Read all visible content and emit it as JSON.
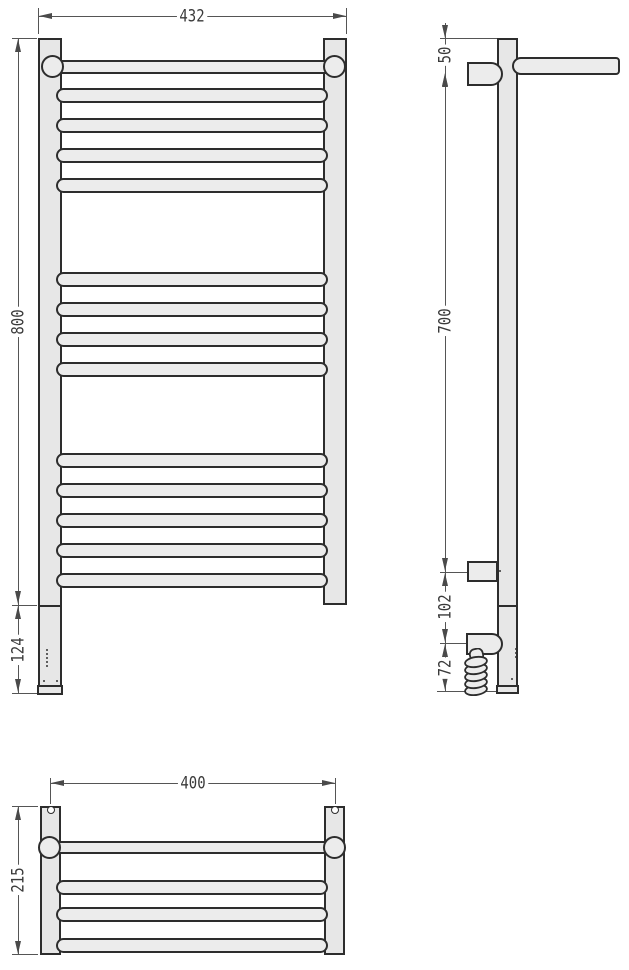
{
  "drawing": {
    "front_view": {
      "overall_width_mm": "432",
      "overall_height_mm": "800",
      "bottom_section_mm": "124"
    },
    "side_view": {
      "top_bracket_offset_mm": "50",
      "bracket_span_mm": "700",
      "lower_bracket_offset_mm": "102",
      "cable_outlet_offset_mm": "72"
    },
    "top_view": {
      "mounting_width_mm": "400",
      "depth_mm": "215"
    }
  },
  "colors": {
    "outline": "#2d2d2d",
    "shape_fill": "#ececec",
    "post_fill": "#e7e7e7",
    "dimension_line": "#555555",
    "text": "#3a3a3a",
    "background": "#ffffff"
  }
}
